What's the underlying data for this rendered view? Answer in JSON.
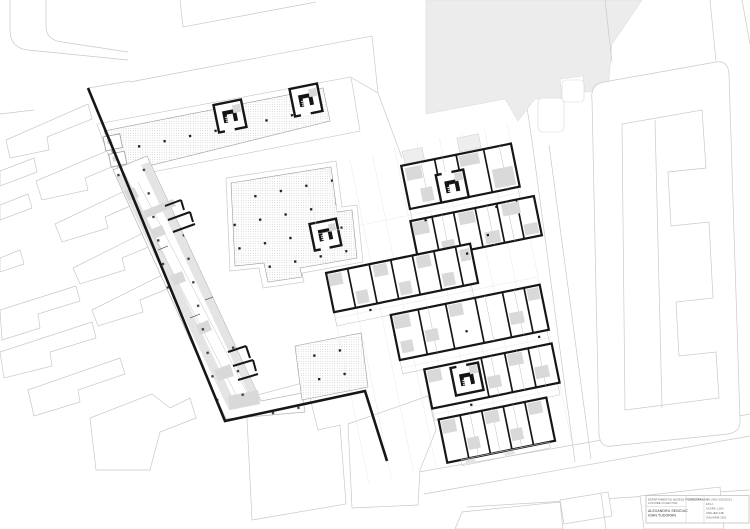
{
  "document": {
    "type": "architectural-site-plan",
    "description": "Black and white collective-housing site plan with stippled plaza decks, perimeter context buildings and clustered dwelling units",
    "plan_rotation_deg": -11.5
  },
  "title_block": {
    "department_line1": "DEPARTAMENTUL BAZELE PROIECTARII",
    "department_line2": "LOCUIRE COLECTIVA",
    "authors": [
      "ALEXANDRU SENCIUC",
      "IOAN TUDORAN"
    ],
    "catedra": "CATEDRA AN 3",
    "info_lines": [
      "AN UNIV 2020/2021",
      "ETAJ",
      "SCARA 1:200",
      "ATELIER 24B",
      "IANUARIE 2021"
    ]
  },
  "colors": {
    "ink": "#161616",
    "room_gray": "#d9d9d9",
    "context_gray": "#ececec",
    "line_light": "#c9c9c9",
    "line_mid": "#9a9a9a",
    "paper": "#ffffff"
  }
}
